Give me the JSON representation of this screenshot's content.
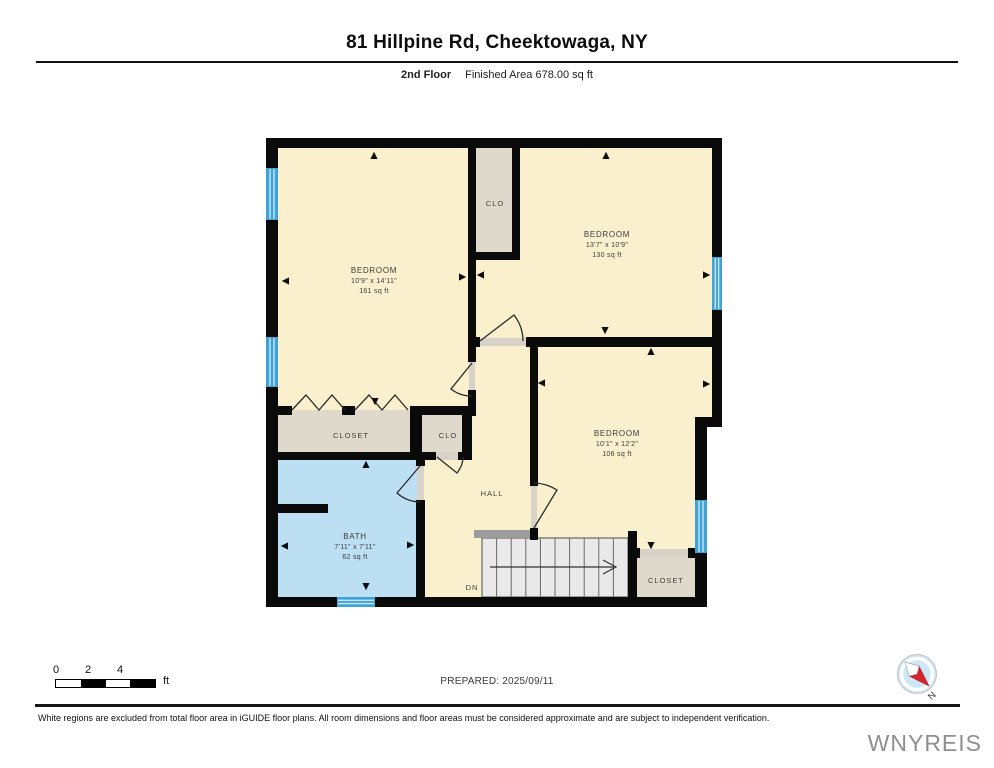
{
  "header": {
    "title": "81 Hillpine Rd, Cheektowaga, NY",
    "floor_label": "2nd Floor",
    "area_label": "Finished Area 678.00 sq ft"
  },
  "plan": {
    "rooms": [
      {
        "id": "bedroom-left",
        "name": "BEDROOM",
        "dims": "10'9\" x 14'11\"",
        "area": "161 sq ft"
      },
      {
        "id": "bedroom-top-right",
        "name": "BEDROOM",
        "dims": "13'7\" x 10'9\"",
        "area": "130 sq ft"
      },
      {
        "id": "bedroom-right",
        "name": "BEDROOM",
        "dims": "10'1\" x 12'2\"",
        "area": "106 sq ft"
      },
      {
        "id": "bath",
        "name": "BATH",
        "dims": "7'11\" x 7'11\"",
        "area": "62 sq ft"
      }
    ],
    "labels": {
      "closet_left": "CLOSET",
      "closet_bottom_right": "CLOSET",
      "clo_top": "CLO",
      "clo_middle": "CLO",
      "hall": "HALL",
      "stairs_down": "DN"
    },
    "colors": {
      "wall": "#0a0a0a",
      "room": "#FAF0CE",
      "closet": "#DFD9CC",
      "bath": "#BCDFF4",
      "window": "#3FA3D6",
      "window_stripe": "#C9E6F6",
      "stairs": "#E9E9E9",
      "threshold": "#D8D2C8"
    }
  },
  "scale_bar": {
    "ticks": [
      "0",
      "2",
      "4"
    ],
    "unit": "ft"
  },
  "prepared": {
    "label": "PREPARED: 2025/09/11"
  },
  "compass": {
    "label": "N"
  },
  "footer": {
    "disclaimer": "White regions are excluded from total floor area in iGUIDE floor plans. All room dimensions and floor areas must be considered approximate and are subject to independent verification.",
    "watermark": "WNYREIS"
  }
}
